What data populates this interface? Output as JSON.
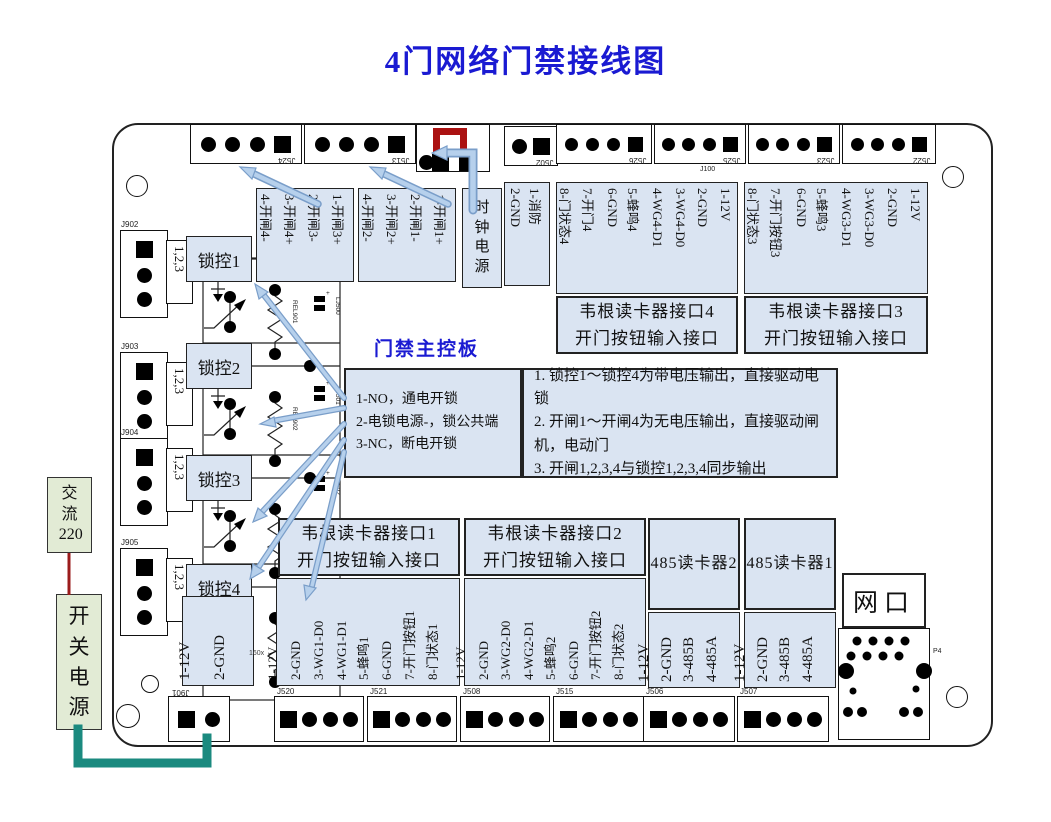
{
  "title": "4门网络门禁接线图",
  "board_label": "门禁主控板",
  "external": {
    "ac_label": "交 流 220",
    "psu_label": "开 关 电 源"
  },
  "clock_power_label": "时 钟 电 源",
  "network": {
    "label": "网口",
    "port_label": "P4"
  },
  "top_connectors": [
    "J524",
    "J513",
    "J502",
    "J526",
    "J525",
    "J523",
    "J522"
  ],
  "aux_labels": {
    "j100": "J100",
    "size_note": "160x"
  },
  "left_connectors": {
    "ids": [
      "J902",
      "J903",
      "J904",
      "J905"
    ],
    "pin_note": "1,2,3"
  },
  "lock_controls": [
    "锁控1",
    "锁控2",
    "锁控3",
    "锁控4"
  ],
  "gate_pin_boxes": [
    {
      "pins": [
        "4-开闸4-",
        "3-开闸4+",
        "2-开闸3-",
        "1-开闸3+"
      ]
    },
    {
      "pins": [
        "4-开闸2-",
        "3-开闸2+",
        "2-开闸1-",
        "1-开闸1+"
      ]
    }
  ],
  "fire_pins": [
    "2-GND",
    "1-消防"
  ],
  "wiegand4": {
    "title": "韦根读卡器接口4",
    "subtitle": "开门按钮输入接口",
    "pins": [
      "8-门状态4",
      "7-开门4",
      "6-GND",
      "5-蜂鸣4",
      "4-WG4-D1",
      "3-WG4-D0",
      "2-GND",
      "1-12V"
    ]
  },
  "wiegand3": {
    "title": "韦根读卡器接口3",
    "subtitle": "开门按钮输入接口",
    "pins": [
      "8-门状态3",
      "7-开门按钮3",
      "6-GND",
      "5-蜂鸣3",
      "4-WG3-D1",
      "3-WG3-D0",
      "2-GND",
      "1-12V"
    ]
  },
  "wiegand1": {
    "title": "韦根读卡器接口1",
    "subtitle": "开门按钮输入接口",
    "pins": [
      "1-12V",
      "2-GND",
      "3-WG1-D0",
      "4-WG1-D1",
      "5-蜂鸣1",
      "6-GND",
      "7-开门按钮1",
      "8-门状态1"
    ]
  },
  "wiegand2": {
    "title": "韦根读卡器接口2",
    "subtitle": "开门按钮输入接口",
    "pins": [
      "1-12V",
      "2-GND",
      "3-WG2-D0",
      "4-WG2-D1",
      "5-蜂鸣2",
      "6-GND",
      "7-开门按钮2",
      "8-门状态2"
    ]
  },
  "rs485_2": {
    "label": "485读卡器2",
    "pins": [
      "1-12V",
      "2-GND",
      "3-485B",
      "4-485A"
    ]
  },
  "rs485_1": {
    "label": "485读卡器1",
    "pins": [
      "1-12V",
      "2-GND",
      "3-485B",
      "4-485A"
    ]
  },
  "power_input_pins": [
    "1-12V",
    "2-GND"
  ],
  "bottom_connectors": [
    "J901",
    "J520",
    "J521",
    "J508",
    "J515",
    "J506",
    "J507"
  ],
  "notes": {
    "lock_pins": [
      "1-NO，通电开锁",
      "2-电锁电源-，锁公共端",
      "3-NC，断电开锁"
    ],
    "rules": [
      "1. 锁控1～锁控4为带电压输出，直接驱动电锁",
      "2. 开闸1～开闸4为无电压输出，直接驱动闸机，电动门",
      "3. 开闸1,2,3,4与锁控1,2,3,4同步输出"
    ]
  },
  "components": {
    "relays": [
      "REL901",
      "REL902",
      "REL903",
      "REL904"
    ],
    "capacitors": [
      "LJ500",
      "LJ501",
      "LJ502"
    ]
  },
  "colors": {
    "box_fill": "#dae4f2",
    "green_fill": "#e2ebd5",
    "arrow_fill": "#b6d0ec",
    "arrow_edge": "#7a9ec9",
    "title_blue": "#1a1ad2",
    "wire_red": "#9b1c1c",
    "wire_teal": "#1b8a7f",
    "jumper_red": "#ab1212"
  }
}
